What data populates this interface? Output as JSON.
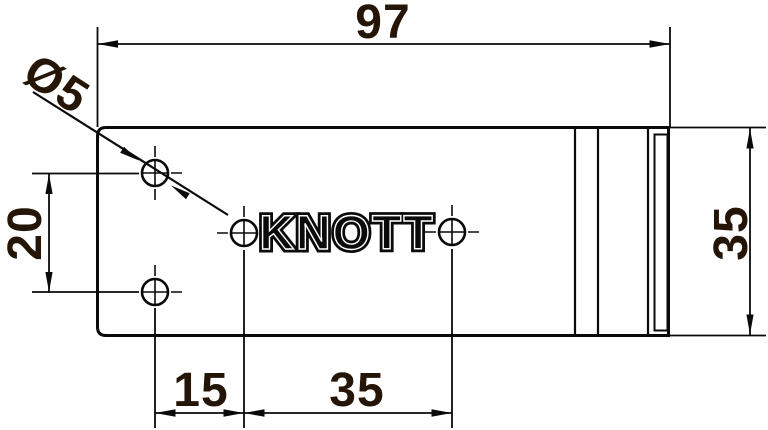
{
  "part": {
    "brand_label": "KNOTT"
  },
  "dimensions": {
    "overall_width": "97",
    "hole_diameter": "Ø5",
    "hole_vertical_spacing": "20",
    "side_height": "35",
    "bottom_offset_left": "15",
    "bottom_offset_right": "35"
  },
  "colors": {
    "line": "#0a0a0a",
    "dimension_text": "#241507",
    "background": "#ffffff"
  }
}
